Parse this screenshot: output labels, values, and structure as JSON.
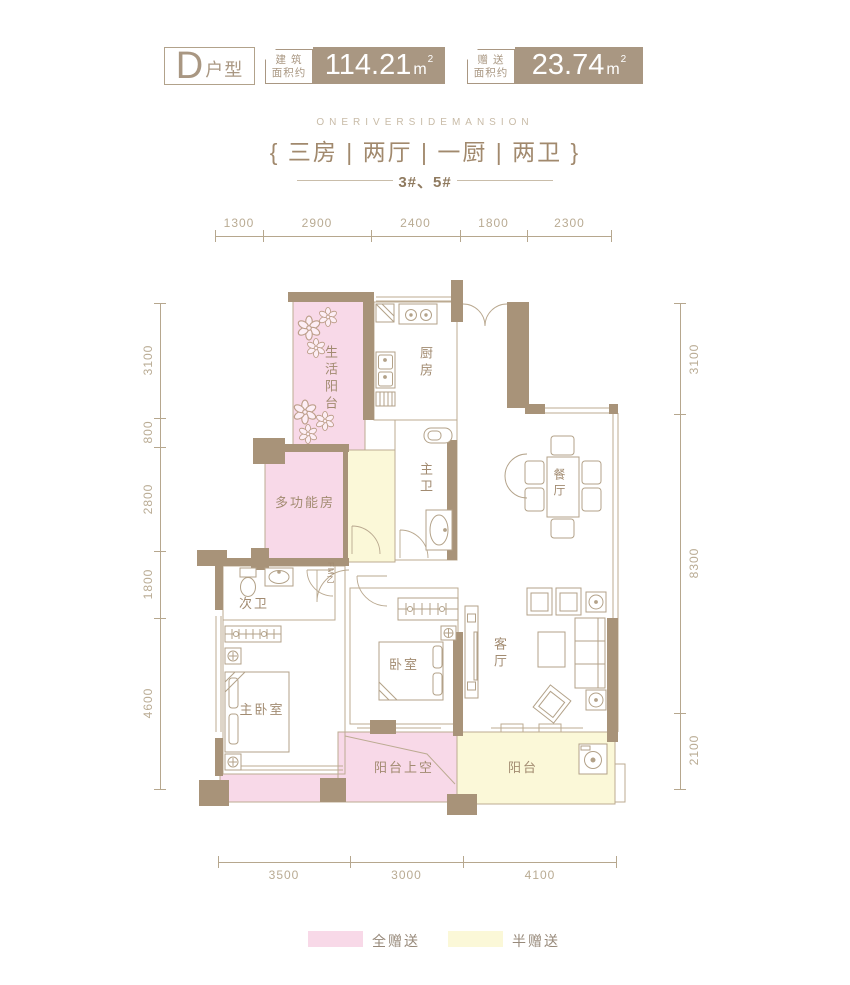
{
  "header": {
    "unit": {
      "letter": "D",
      "type_suffix": "户型"
    },
    "area_badges": [
      {
        "label_top": "建 筑",
        "label_bottom": "面积约",
        "value": "114.21",
        "unit": "m",
        "power": "2"
      },
      {
        "label_top": "赠 送",
        "label_bottom": "面积约",
        "value": "23.74",
        "unit": "m",
        "power": "2"
      }
    ]
  },
  "subtitle": {
    "english": "ONERIVERSIDEMANSION",
    "rooms_spec": "{ 三房 | 两厅 | 一厨 | 两卫 }",
    "buildings": "3#、5#"
  },
  "dimensions": {
    "top": [
      "1300",
      "2900",
      "2400",
      "1800",
      "2300"
    ],
    "left": [
      "3100",
      "800",
      "2800",
      "1800",
      "4600"
    ],
    "right": [
      "3100",
      "8300",
      "2100"
    ],
    "bottom": [
      "3500",
      "3000",
      "4100"
    ]
  },
  "rooms": {
    "life_balcony": "生活阳台",
    "kitchen": "厨房",
    "master_bath": "主卫",
    "dining": "餐厅",
    "multi_function": "多功能房",
    "second_bath": "次卫",
    "master_bedroom": "主卧室",
    "bedroom": "卧室",
    "living": "客厅",
    "balcony_void": "阳台上空",
    "balcony": "阳台",
    "fire_door": "FM乙"
  },
  "legend": [
    {
      "label": "全赠送",
      "color": "#f8d9e8"
    },
    {
      "label": "半赠送",
      "color": "#fbf8d8"
    }
  ],
  "colors": {
    "wall": "#a89379",
    "accent": "#a99782",
    "thin_line": "#bcab92",
    "gift_full": "#f8d9e8",
    "gift_half": "#fbf8d8",
    "dim_text": "#b9ab93",
    "label_text": "#a28b71"
  }
}
